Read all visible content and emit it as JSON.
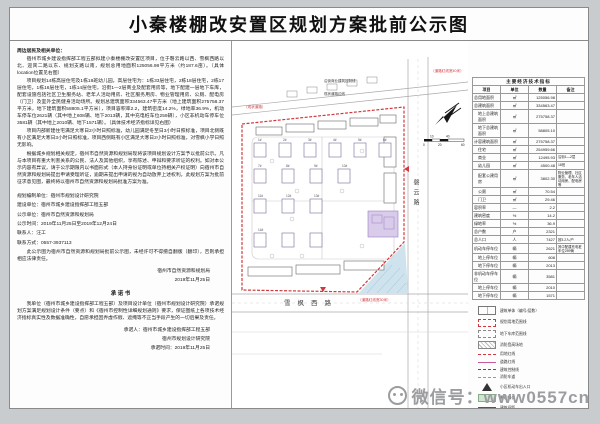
{
  "page": {
    "title": "小秦楼棚改安置区规划方案批前公示图",
    "watermark_text": "微信号：www0557cn",
    "colors": {
      "boundary_red": "#d2383e",
      "accent_pink": "#c85a9b",
      "kindergarten_purple": "#d9cbea",
      "water_blue": "#cfe3ee",
      "watermark_gray": "#9b9da0"
    }
  },
  "notice": {
    "salutation": "周边居民及相关单位：",
    "para1": "宿州市城乡建设指挥部工程五部拟建小秦楼棚改安置区项目，位于磬云路以西、雪枫西路以北、迎宾二路以东、规划支路以南，规划总用地面积125056.98平方米（约187.6亩）。（具体location位置见右图）",
    "para2": "项目规划14栋高层住宅及1栋18班幼儿园，高层住宅为：1栋33层住宅，2栋18层住宅，2栋17层住宅，1栋16层住宅，1栋14层住宅，沿街1—2层商业及配套用房等，地下配建一层地下车库，配套设施包括社区卫生服务站、老年人活动用房、社区服务用房、物业管理用房、公厕、配电房（门卫）及室外全民健身活动场所。规划总建筑面积334563.47平方米（地上建筑面积275758.37平方米，地下建筑面积58805.1平方米），项目容积率2.2，建筑密度14.2%，绿地率36.9%，机动车停车位2621辆（其中地上608辆、地下2013辆，其中充电桩车位259辆），小区非机动车停车位3581辆（其中地上2010辆、地下1571辆）。（具体技术经济指标详见右图）",
    "para3": "项目内部新建住宅满足大寒日2小时日照标准，幼儿园满足冬至日3小时日照标准，项目北侧既有小区满足大寒日3小时日照标准，项目西侧既有小区满足大寒日2小时日照标准，对雪枫小学日照无影响。",
    "para4": "根据城乡规划相关规定，宿州市自然资源和规划局现将该项目规划设计方案予以批前公示。凡与本项目有重大利害关系的公民、法人及其他组织，享有陈述、申辩和要求听证的权利。如对本公示内容有异议，请于公示期限内以书面形式（本人持身份证明或单位持相关产权证明）向宿州市自然资源和规划局提出申请受理听证，逾期未提出申请的视为自动放弃上述权利。此规划方案为批前征求意见图，最终将以宿州市自然资源和规划局批准方案为准。",
    "info": [
      "规划编制单位：宿州市规划设计研究院",
      "建设单位：宿州市城乡建设指挥部工程五部",
      "公示单位：宿州市自然资源和规划局",
      "公示时间：2019年11月25日至2019年12月24日",
      "联系人：汪工",
      "联系方式：0557-3937113"
    ],
    "disclaimer": "此公示图为宿州市自然资源和规划局批前公示图，未经许可不得擅自翻版（翻印），否则承担相应法律责任。",
    "issuer": "宿州市自然资源和规划局",
    "issue_date": "2019年11月25日",
    "commitment": {
      "title": "承 诺 书",
      "body": "我单位（宿州市城乡建设指挥部工程五部）及项目设计单位（宿州市规划设计研究院）承诺规划方案满足规划设计条件（要点）和《宿州市控制性详细规划通则》要求，保证图纸上各项技术经济指标真实性及数据准确性，自愿承担因弄虚作假、遮掩等不正当手段产生的一切后果及责任。",
      "sign1": "承诺人：宿州市城乡建设指挥部工程五部",
      "sign2": "宿州市规划设计研究院",
      "date": "承诺时间：2019年11月25日"
    }
  },
  "map": {
    "road_bottom": "雪枫西路",
    "road_right": "磬云路",
    "note_existing_road": "（现状道路）",
    "note_red_right": "（道路红线宽40米）",
    "note_red_bottom": "（道路红线宽30米）",
    "note_control_line": "沿街商业建筑控制线",
    "note_road_edge": "现状道路边线",
    "building_labels": [
      "1#",
      "2#",
      "3#",
      "4#",
      "5#",
      "6#",
      "7#",
      "8#",
      "9#",
      "10#",
      "11#",
      "12#",
      "13#",
      "14#"
    ],
    "scale": {
      "l0": "0",
      "l10": "10",
      "l20": "20",
      "l40": "40",
      "l60": "60"
    }
  },
  "table": {
    "title": "主要经济技术指标",
    "headers": [
      "项目",
      "单位",
      "数量",
      "备注"
    ],
    "rows": [
      {
        "item": "总用地面积",
        "unit": "㎡",
        "qty": "125056.98",
        "note": "",
        "indent": false
      },
      {
        "item": "总建筑面积",
        "unit": "㎡",
        "qty": "334563.47",
        "note": "",
        "indent": false
      },
      {
        "item": "地上总建筑面积",
        "unit": "㎡",
        "qty": "275758.37",
        "note": "",
        "indent": true
      },
      {
        "item": "地下总建筑面积",
        "unit": "㎡",
        "qty": "58805.10",
        "note": "",
        "indent": true
      },
      {
        "item": "计容建筑面积",
        "unit": "㎡",
        "qty": "275758.37",
        "note": "",
        "indent": false
      },
      {
        "item": "住宅",
        "unit": "㎡",
        "qty": "254959.66",
        "note": "",
        "indent": true
      },
      {
        "item": "商业",
        "unit": "㎡",
        "qty": "12495.93",
        "note": "沿街1—2层",
        "indent": true
      },
      {
        "item": "幼儿园",
        "unit": "㎡",
        "qty": "4500.48",
        "note": "18班",
        "indent": true
      },
      {
        "item": "配套公建用房",
        "unit": "㎡",
        "qty": "3802.30",
        "note": "物业管理、社区服务、老年人活动用房、配电房等",
        "indent": true
      },
      {
        "item": "公厕",
        "unit": "㎡",
        "qty": "70.54",
        "note": "",
        "indent": true
      },
      {
        "item": "门卫",
        "unit": "㎡",
        "qty": "29.46",
        "note": "",
        "indent": true
      },
      {
        "item": "容积率",
        "unit": "—",
        "qty": "2.2",
        "note": "",
        "indent": false
      },
      {
        "item": "建筑密度",
        "unit": "%",
        "qty": "14.2",
        "note": "",
        "indent": false
      },
      {
        "item": "绿地率",
        "unit": "%",
        "qty": "36.9",
        "note": "",
        "indent": false
      },
      {
        "item": "总户数",
        "unit": "户",
        "qty": "2321",
        "note": "",
        "indent": false
      },
      {
        "item": "总人口",
        "unit": "人",
        "qty": "7427",
        "note": "按3.2人/户",
        "indent": false
      },
      {
        "item": "机动车停车位",
        "unit": "辆",
        "qty": "2621",
        "note": "其中配建充电桩车位259辆",
        "indent": false
      },
      {
        "item": "地上停车位",
        "unit": "辆",
        "qty": "608",
        "note": "",
        "indent": true
      },
      {
        "item": "地下停车位",
        "unit": "辆",
        "qty": "2013",
        "note": "",
        "indent": true
      },
      {
        "item": "非机动车停车位",
        "unit": "辆",
        "qty": "3581",
        "note": "",
        "indent": false
      },
      {
        "item": "地上停车位",
        "unit": "辆",
        "qty": "2010",
        "note": "",
        "indent": true
      },
      {
        "item": "地下停车位",
        "unit": "辆",
        "qty": "1571",
        "note": "",
        "indent": true
      }
    ]
  },
  "legend": {
    "items": [
      {
        "sym": "building",
        "label": "建筑单体（编号/层数）"
      },
      {
        "sym": "red-rect",
        "label": "规划用地范围线"
      },
      {
        "sym": "dash-rect",
        "label": "地下车库范围线"
      },
      {
        "sym": "hatch-rect",
        "label": "消防登高场地"
      },
      {
        "sym": "red-dash",
        "label": "用地红线"
      },
      {
        "sym": "pink-line",
        "label": "道路红线"
      },
      {
        "sym": "dashdot",
        "label": "建筑控制线"
      },
      {
        "sym": "dash",
        "label": "消防车道"
      },
      {
        "sym": "arrow",
        "label": "小区机动车出入口"
      },
      {
        "sym": "green-rect",
        "label": "景观绿化"
      },
      {
        "sym": "dim-line",
        "label": "建筑间距"
      },
      {
        "sym": "ramp",
        "label": "地下车库出入口"
      },
      {
        "sym": "wall",
        "label": "围墙"
      }
    ]
  }
}
